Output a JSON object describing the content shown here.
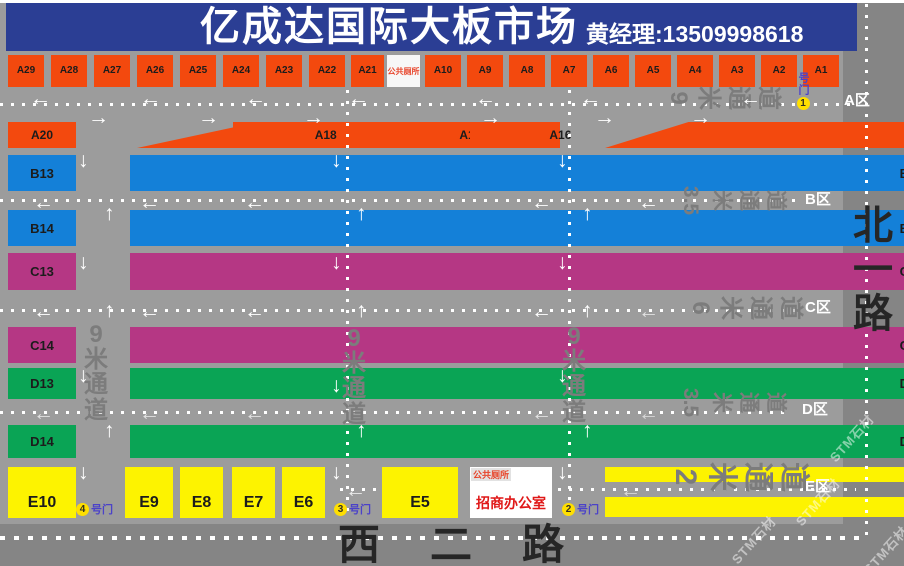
{
  "header": {
    "title": "亿成达国际大板市场",
    "contact": "黄经理:13509998618"
  },
  "roads": {
    "east": "北一路",
    "south": "西二路"
  },
  "facilities": {
    "wc": "公共厕所",
    "office": "招商办公室"
  },
  "watermark": "STM石材",
  "colors": {
    "orange": "#f3490e",
    "blue": "#1480d8",
    "magenta": "#b53784",
    "green": "#0aa455",
    "yellow": "#fdf300",
    "header_bg": "#2b3e94",
    "bg": "#9c9c9c",
    "road": "#858585",
    "aisle": "#7c7c7c",
    "red_text": "#e8442a",
    "office_red": "#e01818",
    "gate_blue": "#4b42c8",
    "road_name": "#262626"
  },
  "zones": [
    {
      "label": "A区",
      "x": 844,
      "y": 93
    },
    {
      "label": "B区",
      "x": 805,
      "y": 192
    },
    {
      "label": "C区",
      "x": 805,
      "y": 300
    },
    {
      "label": "D区",
      "x": 802,
      "y": 402
    },
    {
      "label": "E区",
      "x": 805,
      "y": 479
    }
  ],
  "aisles_h": [
    {
      "t": [
        "9",
        "米",
        "通",
        "道"
      ],
      "x": 666,
      "y": 86,
      "f": 24
    },
    {
      "t": [
        "3.5",
        "米",
        "通",
        "道"
      ],
      "x": 676,
      "y": 190,
      "f": 21
    },
    {
      "t": [
        "6",
        "米",
        "通",
        "道"
      ],
      "x": 688,
      "y": 296,
      "f": 24
    },
    {
      "t": [
        "3.5",
        "米",
        "通",
        "道"
      ],
      "x": 676,
      "y": 392,
      "f": 21
    },
    {
      "t": [
        "2",
        "米",
        "通",
        "道"
      ],
      "x": 670,
      "y": 462,
      "f": 30
    }
  ],
  "aisles_v": [
    {
      "t": [
        "9",
        "米",
        "通",
        "道"
      ],
      "x": 84,
      "y": 322,
      "f": 24
    },
    {
      "t": [
        "9",
        "米",
        "通",
        "道"
      ],
      "x": 342,
      "y": 326,
      "f": 24
    },
    {
      "t": [
        "9",
        "米",
        "通",
        "道"
      ],
      "x": 562,
      "y": 324,
      "f": 24
    }
  ],
  "gates": [
    {
      "num": "4",
      "label": "号门",
      "x": 76,
      "y": 501
    },
    {
      "num": "3",
      "label": "号门",
      "x": 334,
      "y": 501
    },
    {
      "num": "2",
      "label": "号门",
      "x": 562,
      "y": 501
    },
    {
      "num": "1",
      "label": "号门",
      "x": 795,
      "y": 72,
      "vert": true
    }
  ],
  "watermarks": [
    {
      "x": 822,
      "y": 428
    },
    {
      "x": 788,
      "y": 492
    },
    {
      "x": 724,
      "y": 530
    },
    {
      "x": 856,
      "y": 540
    }
  ],
  "blocks": [
    {
      "i": "A29",
      "x": 8,
      "y": 55,
      "w": 36,
      "h": 32,
      "c": "o",
      "f": 10
    },
    {
      "i": "A28",
      "x": 51,
      "y": 55,
      "w": 36,
      "h": 32,
      "c": "o",
      "f": 10
    },
    {
      "i": "A27",
      "x": 94,
      "y": 55,
      "w": 36,
      "h": 32,
      "c": "o",
      "f": 10
    },
    {
      "i": "A26",
      "x": 137,
      "y": 55,
      "w": 36,
      "h": 32,
      "c": "o",
      "f": 10
    },
    {
      "i": "A25",
      "x": 180,
      "y": 55,
      "w": 36,
      "h": 32,
      "c": "o",
      "f": 10
    },
    {
      "i": "A24",
      "x": 223,
      "y": 55,
      "w": 36,
      "h": 32,
      "c": "o",
      "f": 10
    },
    {
      "i": "A23",
      "x": 266,
      "y": 55,
      "w": 36,
      "h": 32,
      "c": "o",
      "f": 10
    },
    {
      "i": "A22",
      "x": 309,
      "y": 55,
      "w": 36,
      "h": 32,
      "c": "o",
      "f": 10
    },
    {
      "i": "A21",
      "x": 351,
      "y": 55,
      "w": 33,
      "h": 32,
      "c": "o",
      "f": 10
    },
    {
      "i": "A10",
      "x": 425,
      "y": 55,
      "w": 36,
      "h": 32,
      "c": "o",
      "f": 10
    },
    {
      "i": "A9",
      "x": 467,
      "y": 55,
      "w": 36,
      "h": 32,
      "c": "o",
      "f": 10
    },
    {
      "i": "A8",
      "x": 509,
      "y": 55,
      "w": 36,
      "h": 32,
      "c": "o",
      "f": 10
    },
    {
      "i": "A7",
      "x": 551,
      "y": 55,
      "w": 36,
      "h": 32,
      "c": "o",
      "f": 10
    },
    {
      "i": "A6",
      "x": 593,
      "y": 55,
      "w": 36,
      "h": 32,
      "c": "o",
      "f": 10
    },
    {
      "i": "A5",
      "x": 635,
      "y": 55,
      "w": 36,
      "h": 32,
      "c": "o",
      "f": 10
    },
    {
      "i": "A4",
      "x": 677,
      "y": 55,
      "w": 36,
      "h": 32,
      "c": "o",
      "f": 10
    },
    {
      "i": "A3",
      "x": 719,
      "y": 55,
      "w": 36,
      "h": 32,
      "c": "o",
      "f": 10
    },
    {
      "i": "A2",
      "x": 761,
      "y": 55,
      "w": 36,
      "h": 32,
      "c": "o",
      "f": 10
    },
    {
      "i": "A1",
      "x": 803,
      "y": 55,
      "w": 36,
      "h": 32,
      "c": "o",
      "f": 10
    },
    {
      "i": "A20",
      "x": 8,
      "y": 122,
      "w": 68,
      "h": 26,
      "c": "o",
      "f": 12
    },
    {
      "i": "A19",
      "x": 137,
      "y": 122,
      "w": 86,
      "h": 26,
      "c": "o",
      "f": 12,
      "p": 32,
      "k": "0 100%,42% 0,100% 0,100% 100%"
    },
    {
      "i": "A18",
      "x": 233,
      "y": 122,
      "w": 95,
      "h": 26,
      "c": "o",
      "f": 12,
      "p": 10
    },
    {
      "i": "A17",
      "x": 380,
      "y": 122,
      "w": 76,
      "h": 26,
      "c": "o",
      "f": 12,
      "p": 10
    },
    {
      "i": "A16",
      "x": 470,
      "y": 122,
      "w": 82,
      "h": 26,
      "c": "o",
      "f": 12,
      "p": 10
    },
    {
      "i": "A15-A11",
      "x": 605,
      "y": 122,
      "w": 198,
      "h": 26,
      "c": "o",
      "f": 12,
      "p": 42,
      "k": "0 100%,22% 0,100% 0,100% 100%"
    },
    {
      "i": "B13",
      "x": 8,
      "y": 155,
      "w": 68,
      "h": 36,
      "c": "b"
    },
    {
      "i": "B11",
      "x": 130,
      "y": 155,
      "w": 92,
      "h": 36,
      "c": "b",
      "p": 22
    },
    {
      "i": "B9",
      "x": 233,
      "y": 155,
      "w": 95,
      "h": 36,
      "c": "b",
      "p": 22
    },
    {
      "i": "B7",
      "x": 380,
      "y": 155,
      "w": 76,
      "h": 36,
      "c": "b",
      "p": 22
    },
    {
      "i": "B5",
      "x": 470,
      "y": 155,
      "w": 82,
      "h": 36,
      "c": "b",
      "p": 22
    },
    {
      "i": "B3",
      "x": 605,
      "y": 155,
      "w": 95,
      "h": 36,
      "c": "b",
      "p": 22
    },
    {
      "i": "B1",
      "x": 709,
      "y": 155,
      "w": 94,
      "h": 36,
      "c": "b",
      "p": 22
    },
    {
      "i": "B14",
      "x": 8,
      "y": 210,
      "w": 68,
      "h": 36,
      "c": "b"
    },
    {
      "i": "B12",
      "x": 130,
      "y": 210,
      "w": 92,
      "h": 36,
      "c": "b",
      "p": 22
    },
    {
      "i": "B10",
      "x": 233,
      "y": 210,
      "w": 95,
      "h": 36,
      "c": "b",
      "p": 22
    },
    {
      "i": "B8",
      "x": 380,
      "y": 210,
      "w": 76,
      "h": 36,
      "c": "b",
      "p": 22
    },
    {
      "i": "B6",
      "x": 470,
      "y": 210,
      "w": 82,
      "h": 36,
      "c": "b",
      "p": 22
    },
    {
      "i": "B4",
      "x": 605,
      "y": 210,
      "w": 95,
      "h": 36,
      "c": "b",
      "p": 22
    },
    {
      "i": "B2",
      "x": 709,
      "y": 210,
      "w": 94,
      "h": 36,
      "c": "b",
      "p": 22
    },
    {
      "i": "C13",
      "x": 8,
      "y": 253,
      "w": 68,
      "h": 37,
      "c": "m"
    },
    {
      "i": "C11",
      "x": 130,
      "y": 253,
      "w": 92,
      "h": 37,
      "c": "m",
      "p": 22
    },
    {
      "i": "C9",
      "x": 233,
      "y": 253,
      "w": 95,
      "h": 37,
      "c": "m",
      "p": 22
    },
    {
      "i": "C7",
      "x": 380,
      "y": 253,
      "w": 76,
      "h": 37,
      "c": "m",
      "p": 22
    },
    {
      "i": "C5",
      "x": 470,
      "y": 253,
      "w": 82,
      "h": 37,
      "c": "m",
      "p": 22
    },
    {
      "i": "C3",
      "x": 605,
      "y": 253,
      "w": 95,
      "h": 37,
      "c": "m",
      "p": 22
    },
    {
      "i": "C1",
      "x": 709,
      "y": 253,
      "w": 94,
      "h": 37,
      "c": "m",
      "p": 22
    },
    {
      "i": "C14",
      "x": 8,
      "y": 327,
      "w": 68,
      "h": 36,
      "c": "m"
    },
    {
      "i": "C12",
      "x": 130,
      "y": 327,
      "w": 92,
      "h": 36,
      "c": "m",
      "p": 22
    },
    {
      "i": "C10",
      "x": 233,
      "y": 327,
      "w": 95,
      "h": 36,
      "c": "m",
      "p": 22
    },
    {
      "i": "C8",
      "x": 380,
      "y": 327,
      "w": 76,
      "h": 36,
      "c": "m",
      "p": 22
    },
    {
      "i": "C6",
      "x": 470,
      "y": 327,
      "w": 82,
      "h": 36,
      "c": "m",
      "p": 22
    },
    {
      "i": "C4",
      "x": 605,
      "y": 327,
      "w": 95,
      "h": 36,
      "c": "m",
      "p": 22
    },
    {
      "i": "C2",
      "x": 709,
      "y": 327,
      "w": 94,
      "h": 36,
      "c": "m",
      "p": 22
    },
    {
      "i": "D13",
      "x": 8,
      "y": 368,
      "w": 68,
      "h": 31,
      "c": "g"
    },
    {
      "i": "D11",
      "x": 130,
      "y": 368,
      "w": 92,
      "h": 31,
      "c": "g",
      "p": 22
    },
    {
      "i": "D9",
      "x": 233,
      "y": 368,
      "w": 95,
      "h": 31,
      "c": "g",
      "p": 22
    },
    {
      "i": "D7",
      "x": 380,
      "y": 368,
      "w": 76,
      "h": 31,
      "c": "g",
      "p": 22
    },
    {
      "i": "D5",
      "x": 470,
      "y": 368,
      "w": 82,
      "h": 31,
      "c": "g",
      "p": 22
    },
    {
      "i": "D3",
      "x": 605,
      "y": 368,
      "w": 95,
      "h": 31,
      "c": "g",
      "p": 22
    },
    {
      "i": "D1",
      "x": 709,
      "y": 368,
      "w": 94,
      "h": 31,
      "c": "g",
      "p": 22
    },
    {
      "i": "D14",
      "x": 8,
      "y": 425,
      "w": 68,
      "h": 33,
      "c": "g"
    },
    {
      "i": "D12",
      "x": 130,
      "y": 425,
      "w": 92,
      "h": 33,
      "c": "g",
      "p": 22
    },
    {
      "i": "D10",
      "x": 233,
      "y": 425,
      "w": 95,
      "h": 33,
      "c": "g",
      "p": 22
    },
    {
      "i": "D8",
      "x": 380,
      "y": 425,
      "w": 76,
      "h": 33,
      "c": "g",
      "p": 22
    },
    {
      "i": "D6",
      "x": 470,
      "y": 425,
      "w": 82,
      "h": 33,
      "c": "g",
      "p": 22
    },
    {
      "i": "D4",
      "x": 605,
      "y": 425,
      "w": 95,
      "h": 33,
      "c": "g",
      "p": 22
    },
    {
      "i": "D2",
      "x": 709,
      "y": 425,
      "w": 94,
      "h": 33,
      "c": "g",
      "p": 22
    },
    {
      "i": "E10",
      "x": 8,
      "y": 467,
      "w": 68,
      "h": 51,
      "c": "y",
      "f": 16,
      "v": 1
    },
    {
      "i": "E9",
      "x": 125,
      "y": 467,
      "w": 48,
      "h": 51,
      "c": "y",
      "f": 16,
      "v": 1
    },
    {
      "i": "E8",
      "x": 180,
      "y": 467,
      "w": 43,
      "h": 51,
      "c": "y",
      "f": 16,
      "v": 1
    },
    {
      "i": "E7",
      "x": 232,
      "y": 467,
      "w": 43,
      "h": 51,
      "c": "y",
      "f": 16,
      "v": 1
    },
    {
      "i": "E6",
      "x": 282,
      "y": 467,
      "w": 43,
      "h": 51,
      "c": "y",
      "f": 16,
      "v": 1
    },
    {
      "i": "E5",
      "x": 382,
      "y": 467,
      "w": 76,
      "h": 51,
      "c": "y",
      "f": 16,
      "v": 1
    },
    {
      "i": "E3",
      "x": 605,
      "y": 467,
      "w": 95,
      "h": 15,
      "c": "y",
      "f": 12,
      "p": 25
    },
    {
      "i": "E1",
      "x": 709,
      "y": 467,
      "w": 94,
      "h": 15,
      "c": "y",
      "f": 12,
      "p": 25
    },
    {
      "i": "E4",
      "x": 605,
      "y": 497,
      "w": 95,
      "h": 20,
      "c": "y",
      "f": 13,
      "p": 25
    },
    {
      "i": "E2",
      "x": 709,
      "y": 497,
      "w": 94,
      "h": 20,
      "c": "y",
      "f": 13,
      "p": 25
    }
  ],
  "dash_h": [
    {
      "x": 0,
      "y": 103,
      "w": 852
    },
    {
      "x": 0,
      "y": 199,
      "w": 796
    },
    {
      "x": 0,
      "y": 309,
      "w": 796
    },
    {
      "x": 0,
      "y": 411,
      "w": 792
    },
    {
      "x": 340,
      "y": 488,
      "w": 36
    },
    {
      "x": 558,
      "y": 488,
      "w": 298
    },
    {
      "x": 0,
      "y": 536,
      "w": 866,
      "big": true
    }
  ],
  "dash_v": [
    {
      "x": 346,
      "y": 90,
      "h": 427
    },
    {
      "x": 568,
      "y": 90,
      "h": 427
    },
    {
      "x": 865,
      "y": 4,
      "h": 538
    }
  ],
  "arrows": [
    {
      "d": "left",
      "x": 30,
      "y": 88
    },
    {
      "d": "left",
      "x": 140,
      "y": 88
    },
    {
      "d": "left",
      "x": 245,
      "y": 88
    },
    {
      "d": "left",
      "x": 348,
      "y": 88
    },
    {
      "d": "left",
      "x": 475,
      "y": 88
    },
    {
      "d": "left",
      "x": 580,
      "y": 88
    },
    {
      "d": "left",
      "x": 740,
      "y": 88
    },
    {
      "d": "right",
      "x": 88,
      "y": 107
    },
    {
      "d": "right",
      "x": 198,
      "y": 107
    },
    {
      "d": "right",
      "x": 303,
      "y": 107
    },
    {
      "d": "right",
      "x": 480,
      "y": 107
    },
    {
      "d": "right",
      "x": 594,
      "y": 107
    },
    {
      "d": "right",
      "x": 690,
      "y": 107
    },
    {
      "d": "left",
      "x": 33,
      "y": 192
    },
    {
      "d": "left",
      "x": 139,
      "y": 192
    },
    {
      "d": "left",
      "x": 244,
      "y": 192
    },
    {
      "d": "left",
      "x": 531,
      "y": 192
    },
    {
      "d": "left",
      "x": 638,
      "y": 192
    },
    {
      "d": "left",
      "x": 33,
      "y": 301
    },
    {
      "d": "left",
      "x": 139,
      "y": 301
    },
    {
      "d": "left",
      "x": 244,
      "y": 301
    },
    {
      "d": "left",
      "x": 531,
      "y": 301
    },
    {
      "d": "left",
      "x": 638,
      "y": 301,
      "o": 0.7
    },
    {
      "d": "left",
      "x": 33,
      "y": 403,
      "o": 0.7
    },
    {
      "d": "left",
      "x": 139,
      "y": 403,
      "o": 0.7
    },
    {
      "d": "left",
      "x": 244,
      "y": 403,
      "o": 0.7
    },
    {
      "d": "left",
      "x": 531,
      "y": 403,
      "o": 0.7
    },
    {
      "d": "left",
      "x": 638,
      "y": 403,
      "o": 0.6
    },
    {
      "d": "left",
      "x": 345,
      "y": 480,
      "o": 0.8
    },
    {
      "d": "left",
      "x": 620,
      "y": 480,
      "o": 0.6
    },
    {
      "d": "down",
      "x": 78,
      "y": 150
    },
    {
      "d": "down",
      "x": 78,
      "y": 252
    },
    {
      "d": "down",
      "x": 78,
      "y": 365
    },
    {
      "d": "down",
      "x": 78,
      "y": 462
    },
    {
      "d": "down",
      "x": 331,
      "y": 150
    },
    {
      "d": "down",
      "x": 331,
      "y": 252
    },
    {
      "d": "down",
      "x": 331,
      "y": 375
    },
    {
      "d": "down",
      "x": 331,
      "y": 462
    },
    {
      "d": "down",
      "x": 557,
      "y": 150
    },
    {
      "d": "down",
      "x": 557,
      "y": 252
    },
    {
      "d": "down",
      "x": 557,
      "y": 365
    },
    {
      "d": "down",
      "x": 557,
      "y": 462
    },
    {
      "d": "up",
      "x": 104,
      "y": 203
    },
    {
      "d": "up",
      "x": 104,
      "y": 300
    },
    {
      "d": "up",
      "x": 104,
      "y": 420
    },
    {
      "d": "up",
      "x": 356,
      "y": 203
    },
    {
      "d": "up",
      "x": 356,
      "y": 300
    },
    {
      "d": "up",
      "x": 356,
      "y": 420
    },
    {
      "d": "up",
      "x": 582,
      "y": 203
    },
    {
      "d": "up",
      "x": 582,
      "y": 300
    },
    {
      "d": "up",
      "x": 582,
      "y": 420
    }
  ]
}
